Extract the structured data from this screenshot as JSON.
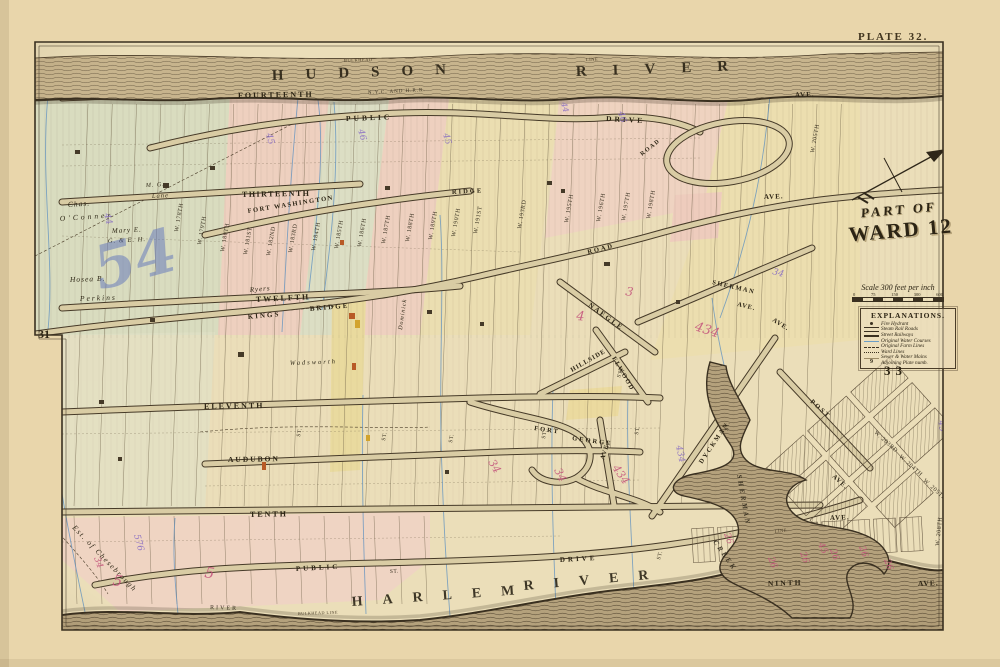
{
  "page": {
    "plate_label": "PLATE 32."
  },
  "title": {
    "line1": "PART OF",
    "line2": "WARD 12"
  },
  "scale": {
    "text": "Scale 300 feet per inch",
    "ticks": [
      "0",
      "75",
      "150",
      "300",
      "600"
    ]
  },
  "explanations": {
    "title": "EXPLANATIONS.",
    "items": [
      {
        "symbol": "fire-hydrant",
        "label": "Fire Hydrant"
      },
      {
        "symbol": "steam-railroad-line",
        "label": "Steam Rail Roads"
      },
      {
        "symbol": "street-railway-line",
        "label": "Street Railways"
      },
      {
        "symbol": "water-course-line",
        "label": "Original Water Courses"
      },
      {
        "symbol": "farm-line",
        "label": "Original Farm Lines"
      },
      {
        "symbol": "ward-line",
        "label": "Ward Lines"
      },
      {
        "symbol": "water-main-line",
        "label": "Sewer & Water Mains"
      },
      {
        "symbol": "plate-number",
        "symbol_text": "9",
        "label": "Adjoining Plate numb."
      }
    ]
  },
  "adjoining_plates": {
    "left": "31",
    "right": "33"
  },
  "colors": {
    "paper": "#e9d6ab",
    "map_field": "#ebdeb9",
    "ink": "#3a3020",
    "block_pink": "#f0c9c4",
    "block_yellow": "#ecdfad",
    "block_green": "#cfdcc3",
    "water_course_blue": "#5b8fc0",
    "annotation_purple": "#8468c4",
    "annotation_pink": "#c4527b",
    "annotation_blue": "#5f74bd",
    "river_ink": "#261f12"
  },
  "map": {
    "labels": [
      {
        "t": "HUDSON",
        "x": 272,
        "y": 80,
        "r": -2,
        "s": 15,
        "ls": 22,
        "k": "river"
      },
      {
        "t": "RIVER",
        "x": 576,
        "y": 76,
        "r": -2,
        "s": 15,
        "ls": 26,
        "k": "river"
      },
      {
        "t": "BULKHEAD",
        "x": 344,
        "y": 62,
        "r": -2,
        "s": 4.5,
        "ls": 0.5,
        "k": "tiny"
      },
      {
        "t": "LINE",
        "x": 586,
        "y": 61,
        "r": -2,
        "s": 4.5,
        "ls": 0.5,
        "k": "tiny"
      },
      {
        "t": "HARLEM",
        "x": 352,
        "y": 606,
        "r": -4,
        "s": 14,
        "ls": 20,
        "k": "river"
      },
      {
        "t": "RIVER",
        "x": 524,
        "y": 590,
        "r": -5,
        "s": 14,
        "ls": 20,
        "k": "river"
      },
      {
        "t": "BULKHEAD LINE",
        "x": 298,
        "y": 615,
        "r": -2,
        "s": 4.2,
        "ls": 0.5,
        "k": "tiny"
      },
      {
        "t": "RIVER",
        "x": 210,
        "y": 609,
        "r": 2,
        "s": 6,
        "ls": 2,
        "k": "small"
      },
      {
        "t": "LINE",
        "x": 775,
        "y": 533,
        "r": -8,
        "s": 4.5,
        "ls": 0.5,
        "k": "tiny"
      },
      {
        "t": "SHERMAN",
        "x": 737,
        "y": 475,
        "r": 80,
        "s": 7,
        "ls": 2.5,
        "k": "water"
      },
      {
        "t": "CREEK",
        "x": 713,
        "y": 542,
        "r": 55,
        "s": 7,
        "ls": 2.5,
        "k": "water"
      },
      {
        "t": "N.Y.C. AND H.R.R.",
        "x": 368,
        "y": 94,
        "r": -3,
        "s": 5,
        "ls": 1,
        "k": "small"
      },
      {
        "t": "FOURTEENTH",
        "x": 238,
        "y": 98,
        "r": -1,
        "s": 8,
        "ls": 2,
        "k": "ave"
      },
      {
        "t": "PUBLIC",
        "x": 346,
        "y": 121,
        "r": -2,
        "s": 7.5,
        "ls": 3,
        "k": "ave"
      },
      {
        "t": "DRIVE",
        "x": 606,
        "y": 121,
        "r": 3,
        "s": 7.5,
        "ls": 3,
        "k": "ave"
      },
      {
        "t": "THIRTEENTH",
        "x": 242,
        "y": 197,
        "r": -1,
        "s": 8,
        "ls": 1.5,
        "k": "ave"
      },
      {
        "t": "FORT WASHINGTON",
        "x": 248,
        "y": 213,
        "r": -9,
        "s": 6.5,
        "ls": 1.5,
        "k": "ave"
      },
      {
        "t": "RIDGE",
        "x": 452,
        "y": 194,
        "r": -3,
        "s": 6.5,
        "ls": 2,
        "k": "ave"
      },
      {
        "t": "ROAD",
        "x": 588,
        "y": 254,
        "r": -14,
        "s": 6.5,
        "ls": 2,
        "k": "ave"
      },
      {
        "t": "ROAD",
        "x": 642,
        "y": 156,
        "r": -38,
        "s": 6,
        "ls": 1.5,
        "k": "ave"
      },
      {
        "t": "TWELFTH",
        "x": 256,
        "y": 302,
        "r": -3,
        "s": 8,
        "ls": 2,
        "k": "ave"
      },
      {
        "t": "KINGS",
        "x": 248,
        "y": 319,
        "r": -5,
        "s": 7,
        "ls": 2,
        "k": "ave"
      },
      {
        "t": "BRIDGE",
        "x": 310,
        "y": 311,
        "r": -5,
        "s": 7,
        "ls": 2,
        "k": "ave"
      },
      {
        "t": "ELEVENTH",
        "x": 204,
        "y": 409,
        "r": -1,
        "s": 8,
        "ls": 2,
        "k": "ave"
      },
      {
        "t": "AUDUBON",
        "x": 228,
        "y": 462,
        "r": -1,
        "s": 7.5,
        "ls": 2,
        "k": "ave"
      },
      {
        "t": "TENTH",
        "x": 250,
        "y": 517,
        "r": -1,
        "s": 8,
        "ls": 2,
        "k": "ave"
      },
      {
        "t": "AVE.",
        "x": 830,
        "y": 520,
        "r": -2,
        "s": 7,
        "ls": 1,
        "k": "ave"
      },
      {
        "t": "NINTH",
        "x": 768,
        "y": 586,
        "r": -2,
        "s": 7.5,
        "ls": 2,
        "k": "ave"
      },
      {
        "t": "AVE.",
        "x": 918,
        "y": 586,
        "r": -2,
        "s": 7.5,
        "ls": 1,
        "k": "ave"
      },
      {
        "t": "PUBLIC",
        "x": 296,
        "y": 571,
        "r": -3,
        "s": 7,
        "ls": 3,
        "k": "ave"
      },
      {
        "t": "DRIVE",
        "x": 560,
        "y": 562,
        "r": -3,
        "s": 7,
        "ls": 3,
        "k": "ave"
      },
      {
        "t": "NAEGLE",
        "x": 588,
        "y": 306,
        "r": 36,
        "s": 7,
        "ls": 2,
        "k": "ave"
      },
      {
        "t": "SHERMAN",
        "x": 712,
        "y": 284,
        "r": 13,
        "s": 6.5,
        "ls": 1.5,
        "k": "ave"
      },
      {
        "t": "AVE.",
        "x": 737,
        "y": 306,
        "r": 13,
        "s": 6.5,
        "ls": 1,
        "k": "ave"
      },
      {
        "t": "AVE.",
        "x": 772,
        "y": 321,
        "r": 32,
        "s": 6.5,
        "ls": 1,
        "k": "ave"
      },
      {
        "t": "ELWOOD",
        "x": 612,
        "y": 358,
        "r": 60,
        "s": 6.5,
        "ls": 1.5,
        "k": "ave"
      },
      {
        "t": "HILLSIDE",
        "x": 572,
        "y": 372,
        "r": -30,
        "s": 6.5,
        "ls": 1,
        "k": "ave"
      },
      {
        "t": "DYCKMAN",
        "x": 702,
        "y": 464,
        "r": -56,
        "s": 6.5,
        "ls": 2,
        "k": "ave"
      },
      {
        "t": "FORT",
        "x": 534,
        "y": 430,
        "r": 8,
        "s": 6.5,
        "ls": 2,
        "k": "ave"
      },
      {
        "t": "GEORGE",
        "x": 572,
        "y": 440,
        "r": 8,
        "s": 6.5,
        "ls": 2,
        "k": "ave"
      },
      {
        "t": "AVE.",
        "x": 604,
        "y": 460,
        "r": -72,
        "s": 6.5,
        "ls": 1,
        "k": "ave"
      },
      {
        "t": "POST",
        "x": 810,
        "y": 402,
        "r": 42,
        "s": 6.5,
        "ls": 2,
        "k": "ave"
      },
      {
        "t": "AVE.",
        "x": 832,
        "y": 477,
        "r": 42,
        "s": 6.5,
        "ls": 1,
        "k": "ave"
      },
      {
        "t": "AVE.",
        "x": 795,
        "y": 97,
        "r": -2,
        "s": 7,
        "ls": 1,
        "k": "ave"
      },
      {
        "t": "AVE.",
        "x": 764,
        "y": 199,
        "r": -2,
        "s": 7,
        "ls": 1,
        "k": "ave"
      },
      {
        "t": "ST.",
        "x": 300,
        "y": 437,
        "r": -80,
        "s": 5.5,
        "ls": 0.5,
        "k": "small"
      },
      {
        "t": "ST.",
        "x": 385,
        "y": 441,
        "r": -80,
        "s": 5.5,
        "ls": 0.5,
        "k": "small"
      },
      {
        "t": "ST.",
        "x": 452,
        "y": 443,
        "r": -80,
        "s": 5.5,
        "ls": 0.5,
        "k": "small"
      },
      {
        "t": "ST.",
        "x": 545,
        "y": 439,
        "r": -80,
        "s": 5.5,
        "ls": 0.5,
        "k": "small"
      },
      {
        "t": "ST.",
        "x": 638,
        "y": 435,
        "r": -80,
        "s": 5.5,
        "ls": 0.5,
        "k": "small"
      },
      {
        "t": "ST.",
        "x": 728,
        "y": 431,
        "r": -80,
        "s": 5.5,
        "ls": 0.5,
        "k": "small"
      },
      {
        "t": "ST.",
        "x": 620,
        "y": 378,
        "r": -70,
        "s": 5.5,
        "ls": 0.5,
        "k": "small"
      },
      {
        "t": "ST.",
        "x": 660,
        "y": 560,
        "r": -75,
        "s": 5.5,
        "ls": 0.5,
        "k": "small"
      },
      {
        "t": "ST.",
        "x": 390,
        "y": 573,
        "r": -4,
        "s": 5.5,
        "ls": 0.5,
        "k": "small"
      },
      {
        "t": "W. 178TH",
        "x": 178,
        "y": 232,
        "r": -80,
        "s": 6,
        "ls": 0.5,
        "k": "st"
      },
      {
        "t": "W. 179TH",
        "x": 201,
        "y": 245,
        "r": -80,
        "s": 6,
        "ls": 0.5,
        "k": "st"
      },
      {
        "t": "W. 180TH",
        "x": 224,
        "y": 252,
        "r": -80,
        "s": 6,
        "ls": 0.5,
        "k": "st"
      },
      {
        "t": "W. 181ST",
        "x": 247,
        "y": 255,
        "r": -80,
        "s": 6,
        "ls": 0.5,
        "k": "st"
      },
      {
        "t": "W. 182ND",
        "x": 270,
        "y": 256,
        "r": -80,
        "s": 6,
        "ls": 0.5,
        "k": "st"
      },
      {
        "t": "W. 183RD",
        "x": 292,
        "y": 253,
        "r": -80,
        "s": 6,
        "ls": 0.5,
        "k": "st"
      },
      {
        "t": "W. 184TH",
        "x": 315,
        "y": 251,
        "r": -80,
        "s": 6,
        "ls": 0.5,
        "k": "st"
      },
      {
        "t": "W. 185TH",
        "x": 338,
        "y": 249,
        "r": -80,
        "s": 6,
        "ls": 0.5,
        "k": "st"
      },
      {
        "t": "W. 186TH",
        "x": 361,
        "y": 247,
        "r": -80,
        "s": 6,
        "ls": 0.5,
        "k": "st"
      },
      {
        "t": "W. 187TH",
        "x": 385,
        "y": 244,
        "r": -80,
        "s": 6,
        "ls": 0.5,
        "k": "st"
      },
      {
        "t": "W. 188TH",
        "x": 409,
        "y": 242,
        "r": -80,
        "s": 6,
        "ls": 0.5,
        "k": "st"
      },
      {
        "t": "W. 189TH",
        "x": 432,
        "y": 240,
        "r": -80,
        "s": 6,
        "ls": 0.5,
        "k": "st"
      },
      {
        "t": "W. 190TH",
        "x": 455,
        "y": 237,
        "r": -80,
        "s": 6,
        "ls": 0.5,
        "k": "st"
      },
      {
        "t": "W. 191ST",
        "x": 477,
        "y": 234,
        "r": -80,
        "s": 6,
        "ls": 0.5,
        "k": "st"
      },
      {
        "t": "W. 193RD",
        "x": 521,
        "y": 229,
        "r": -80,
        "s": 6,
        "ls": 0.5,
        "k": "st"
      },
      {
        "t": "W. 195TH",
        "x": 568,
        "y": 223,
        "r": -80,
        "s": 6,
        "ls": 0.5,
        "k": "st"
      },
      {
        "t": "W. 196TH",
        "x": 600,
        "y": 222,
        "r": -80,
        "s": 6,
        "ls": 0.5,
        "k": "st"
      },
      {
        "t": "W. 197TH",
        "x": 625,
        "y": 221,
        "r": -80,
        "s": 6,
        "ls": 0.5,
        "k": "st"
      },
      {
        "t": "W. 198TH",
        "x": 650,
        "y": 219,
        "r": -80,
        "s": 6,
        "ls": 0.5,
        "k": "st"
      },
      {
        "t": "W. 205TH",
        "x": 814,
        "y": 153,
        "r": -80,
        "s": 6,
        "ls": 0.5,
        "k": "st"
      },
      {
        "t": "W. 208TH",
        "x": 939,
        "y": 546,
        "r": -84,
        "s": 6,
        "ls": 0.5,
        "k": "st"
      },
      {
        "t": "W. 203RD",
        "x": 874,
        "y": 433,
        "r": 42,
        "s": 6,
        "ls": 0.5,
        "k": "st"
      },
      {
        "t": "W. 204TH",
        "x": 899,
        "y": 457,
        "r": 42,
        "s": 6,
        "ls": 0.5,
        "k": "st"
      },
      {
        "t": "W. 205TH",
        "x": 923,
        "y": 481,
        "r": 42,
        "s": 6,
        "ls": 0.5,
        "k": "st"
      },
      {
        "t": "Chas.",
        "x": 68,
        "y": 207,
        "r": -4,
        "s": 7.5,
        "ls": 1,
        "k": "name"
      },
      {
        "t": "O'Conner",
        "x": 60,
        "y": 221,
        "r": -4,
        "s": 7.5,
        "ls": 3,
        "k": "name"
      },
      {
        "t": "Mary E.",
        "x": 112,
        "y": 233,
        "r": -3,
        "s": 7,
        "ls": 1,
        "k": "name"
      },
      {
        "t": "G. & E. H.",
        "x": 108,
        "y": 243,
        "r": -3,
        "s": 6.5,
        "ls": 1,
        "k": "name"
      },
      {
        "t": "Hosea B.",
        "x": 70,
        "y": 282,
        "r": -2,
        "s": 7.5,
        "ls": 1,
        "k": "name"
      },
      {
        "t": "Perkins",
        "x": 80,
        "y": 301,
        "r": -2,
        "s": 7.5,
        "ls": 2,
        "k": "name"
      },
      {
        "t": "M. G.",
        "x": 146,
        "y": 187,
        "r": -3,
        "s": 6,
        "ls": 1,
        "k": "name"
      },
      {
        "t": "Lane",
        "x": 152,
        "y": 198,
        "r": -3,
        "s": 6.5,
        "ls": 1,
        "k": "name"
      },
      {
        "t": "Ryers",
        "x": 250,
        "y": 292,
        "r": -5,
        "s": 7,
        "ls": 1,
        "k": "name"
      },
      {
        "t": "Wadsworth",
        "x": 290,
        "y": 365,
        "r": -2,
        "s": 6.5,
        "ls": 2,
        "k": "name"
      },
      {
        "t": "Est. of Chesebrough",
        "x": 72,
        "y": 528,
        "r": 46,
        "s": 7.5,
        "ls": 1.5,
        "k": "name"
      },
      {
        "t": "Dominick",
        "x": 402,
        "y": 330,
        "r": -82,
        "s": 6,
        "ls": 1,
        "k": "name"
      },
      {
        "t": "54",
        "x": 100,
        "y": 290,
        "r": -15,
        "s": 60,
        "k": "annoB"
      },
      {
        "t": "44",
        "x": 104,
        "y": 214,
        "r": 75,
        "s": 9,
        "k": "annoP"
      },
      {
        "t": "46",
        "x": 358,
        "y": 130,
        "r": 75,
        "s": 9,
        "k": "annoP"
      },
      {
        "t": "45",
        "x": 266,
        "y": 134,
        "r": 75,
        "s": 9,
        "k": "annoP"
      },
      {
        "t": "46",
        "x": 618,
        "y": 112,
        "r": 75,
        "s": 9,
        "k": "annoP"
      },
      {
        "t": "45",
        "x": 443,
        "y": 134,
        "r": 75,
        "s": 9,
        "k": "annoP"
      },
      {
        "t": "44",
        "x": 561,
        "y": 103,
        "r": 75,
        "s": 8,
        "k": "annoP"
      },
      {
        "t": "34",
        "x": 772,
        "y": 274,
        "r": 15,
        "s": 9,
        "k": "annoP"
      },
      {
        "t": "434",
        "x": 676,
        "y": 446,
        "r": 78,
        "s": 9,
        "k": "annoP"
      },
      {
        "t": "576",
        "x": 134,
        "y": 535,
        "r": 75,
        "s": 9,
        "k": "annoP"
      },
      {
        "t": "45",
        "x": 938,
        "y": 421,
        "r": 78,
        "s": 9,
        "k": "annoP"
      },
      {
        "t": "434",
        "x": 694,
        "y": 330,
        "r": 18,
        "s": 13,
        "k": "annoR"
      },
      {
        "t": "3",
        "x": 625,
        "y": 295,
        "r": 10,
        "s": 12,
        "k": "annoR"
      },
      {
        "t": "4",
        "x": 576,
        "y": 320,
        "r": 5,
        "s": 13,
        "k": "annoR"
      },
      {
        "t": "434",
        "x": 612,
        "y": 468,
        "r": 55,
        "s": 11,
        "k": "annoR"
      },
      {
        "t": "34",
        "x": 554,
        "y": 470,
        "r": 65,
        "s": 11,
        "k": "annoR"
      },
      {
        "t": "34",
        "x": 488,
        "y": 462,
        "r": 60,
        "s": 11,
        "k": "annoR"
      },
      {
        "t": "26",
        "x": 768,
        "y": 558,
        "r": 70,
        "s": 9,
        "k": "annoR"
      },
      {
        "t": "26",
        "x": 800,
        "y": 553,
        "r": 70,
        "s": 9,
        "k": "annoR"
      },
      {
        "t": "26",
        "x": 830,
        "y": 550,
        "r": 70,
        "s": 9,
        "k": "annoR"
      },
      {
        "t": "26",
        "x": 859,
        "y": 547,
        "r": 70,
        "s": 9,
        "k": "annoR"
      },
      {
        "t": "26",
        "x": 884,
        "y": 560,
        "r": 70,
        "s": 9,
        "k": "annoR"
      },
      {
        "t": "26",
        "x": 724,
        "y": 534,
        "r": 70,
        "s": 9,
        "k": "annoR"
      },
      {
        "t": "5",
        "x": 112,
        "y": 585,
        "r": 10,
        "s": 15,
        "k": "annoR"
      },
      {
        "t": "5",
        "x": 204,
        "y": 577,
        "r": 10,
        "s": 15,
        "k": "annoR"
      },
      {
        "t": "45",
        "x": 818,
        "y": 544,
        "r": 65,
        "s": 9,
        "k": "annoR"
      },
      {
        "t": "34",
        "x": 94,
        "y": 558,
        "r": 70,
        "s": 9,
        "k": "annoR"
      }
    ]
  }
}
